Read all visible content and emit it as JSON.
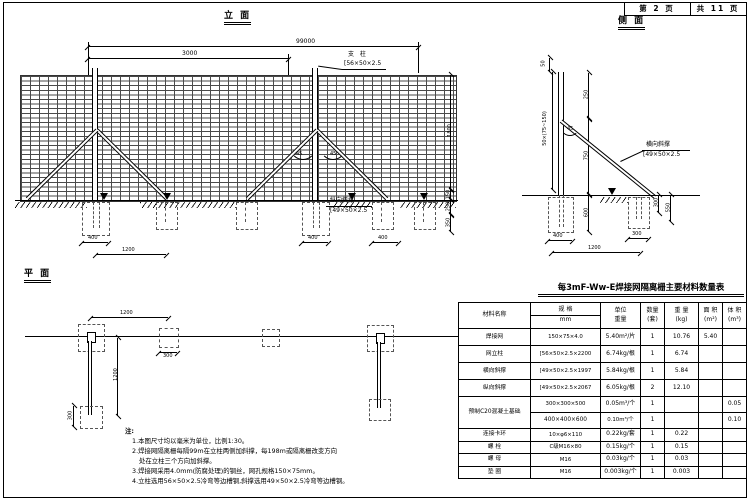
{
  "sheet": {
    "page_no": "第 2 页",
    "pages_total": "共 11 页"
  },
  "elevation": {
    "title": "立 面",
    "dim_overall": "99000",
    "dim_module": "3000",
    "dim_right": [
      "1800",
      "150",
      "250",
      "350"
    ],
    "dim_b1": "400",
    "dim_b2": "1200",
    "dim_b3": "400",
    "dim_b4": "400",
    "angle": "45",
    "post_label": "支 柱",
    "post_spec": "[56×50×2.5",
    "brace_label": "纵向斜撑",
    "brace_spec": "[49×50×2.5"
  },
  "side": {
    "title": "侧 面",
    "dim_top": "50",
    "dim_left": "50×(75~150)",
    "dim_m1": "250",
    "dim_m2": "750",
    "dim_m3": "600",
    "dim_f1": "400",
    "dim_f2": "300",
    "dim_span": "1200",
    "dim_r1": "300",
    "dim_r2": "550",
    "angle": "45",
    "brace_label": "横向斜撑",
    "brace_spec": "[49×50×2.5"
  },
  "plan": {
    "title": "平 面",
    "dim_span": "1200",
    "dim_sq": "300",
    "dim_stem": "1200",
    "dim_foot": "300"
  },
  "notes": {
    "label": "注:",
    "lines": [
      "1.本图尺寸均以毫米为单位，比例1:30。",
      "2.焊接网隔离栅每隔99m在立柱两侧加斜撑，每198m或隔离栅改变方向",
      "处在立柱三个方向加斜撑。",
      "3.焊接网采用4.0mm(防腐处理)的钢丝，网孔规格150×75mm。",
      "4.立柱选用56×50×2.5冷弯等边槽钢,斜撑选用49×50×2.5冷弯等边槽钢。"
    ]
  },
  "table": {
    "title": "每3mF-Ww-E焊接网隔离栅主要材料数量表",
    "headers": {
      "material": "材料名称",
      "spec": "规 格",
      "spec_unit": "mm",
      "unit_weight_1": "单位",
      "unit_weight_2": "重量",
      "qty": "数量",
      "qty_unit": "(套)",
      "weight": "重 量",
      "weight_unit": "(kg)",
      "area": "面 积",
      "area_unit": "(m²)",
      "volume": "体 积",
      "volume_unit": "(m³)"
    },
    "rows": [
      {
        "name": "焊接网",
        "spec": "150×75×4.0",
        "unit_weight": "5.40m²/片",
        "qty": "1",
        "weight": "10.76",
        "area": "5.40",
        "volume": ""
      },
      {
        "name": "网立柱",
        "spec": "[56×50×2.5×2200",
        "unit_weight": "6.74kg/根",
        "qty": "1",
        "weight": "6.74",
        "area": "",
        "volume": ""
      },
      {
        "name": "横向斜撑",
        "spec": "[49×50×2.5×1997",
        "unit_weight": "5.84kg/根",
        "qty": "1",
        "weight": "5.84",
        "area": "",
        "volume": ""
      },
      {
        "name": "纵向斜撑",
        "spec": "[49×50×2.5×2067",
        "unit_weight": "6.05kg/根",
        "qty": "2",
        "weight": "12.10",
        "area": "",
        "volume": ""
      },
      {
        "name": "预制C20混凝土基础",
        "name_rowspan": 2,
        "spec": "300×300×500",
        "unit_weight": "0.05m³/个",
        "qty": "1",
        "weight": "",
        "area": "",
        "volume": "0.05"
      },
      {
        "spec": "400×400×600",
        "unit_weight": "0.10m³/个",
        "qty": "1",
        "weight": "",
        "area": "",
        "volume": "0.10"
      },
      {
        "name": "连接卡环",
        "spec": "10×φ6×110",
        "unit_weight": "0.22kg/套",
        "qty": "1",
        "weight": "0.22",
        "area": "",
        "volume": ""
      },
      {
        "name": "螺 栓",
        "spec": "C级M16×80",
        "unit_weight": "0.15kg/个",
        "qty": "1",
        "weight": "0.15",
        "area": "",
        "volume": ""
      },
      {
        "name": "螺 母",
        "spec": "M16",
        "unit_weight": "0.03kg/个",
        "qty": "1",
        "weight": "0.03",
        "area": "",
        "volume": ""
      },
      {
        "name": "垫 圈",
        "spec": "M16",
        "unit_weight": "0.003kg/个",
        "qty": "1",
        "weight": "0.003",
        "area": "",
        "volume": ""
      }
    ]
  }
}
